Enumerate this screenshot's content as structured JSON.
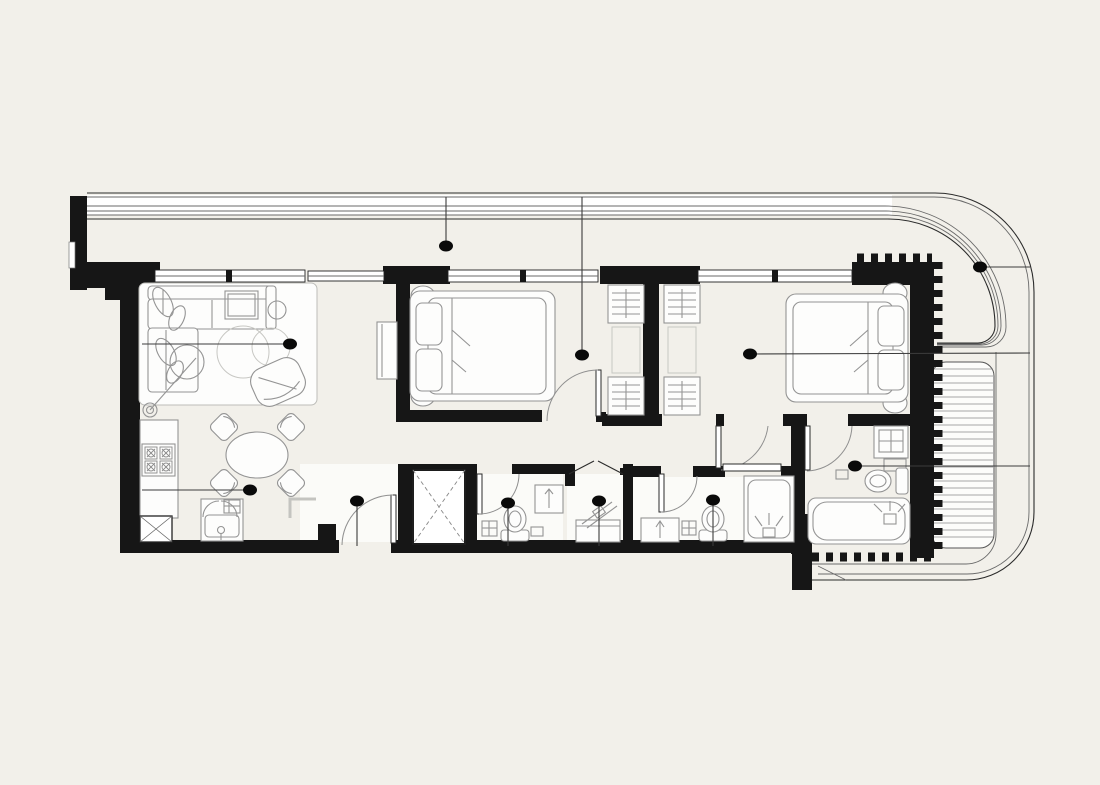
{
  "colors": {
    "background": "#f2f0ea",
    "wall": "#161616",
    "line": "#2b2b2b",
    "furniture": "#949494",
    "accent_dot": "#0a0a0a",
    "floor": "#fbfbf8"
  },
  "plan": {
    "hotspots": [
      {
        "id": "living-room",
        "dot": [
          290,
          344
        ],
        "end": [
          142,
          344
        ]
      },
      {
        "id": "balcony-top",
        "dot": [
          446,
          246
        ],
        "end": [
          446,
          197
        ]
      },
      {
        "id": "bedroom-1",
        "dot": [
          582,
          355
        ],
        "end": [
          582,
          197
        ]
      },
      {
        "id": "bedroom-2",
        "dot": [
          750,
          354
        ],
        "end": [
          1030,
          353
        ]
      },
      {
        "id": "balcony-right",
        "dot": [
          980,
          267
        ],
        "end": [
          1030,
          267
        ]
      },
      {
        "id": "kitchen",
        "dot": [
          250,
          490
        ],
        "end": [
          142,
          490
        ]
      },
      {
        "id": "entrance-hall",
        "dot": [
          357,
          501
        ],
        "end": [
          357,
          546
        ]
      },
      {
        "id": "bathroom-1",
        "dot": [
          508,
          503
        ],
        "end": [
          508,
          546
        ]
      },
      {
        "id": "laundry",
        "dot": [
          599,
          501
        ],
        "end": [
          599,
          546
        ]
      },
      {
        "id": "bathroom-2",
        "dot": [
          713,
          500
        ],
        "end": [
          713,
          546
        ]
      },
      {
        "id": "ensuite-bathroom",
        "dot": [
          855,
          466
        ],
        "end": [
          1030,
          466
        ]
      }
    ],
    "decking": {
      "x1": 933,
      "x2": 993,
      "y_start": 369,
      "y_end": 541,
      "step": 7
    }
  }
}
